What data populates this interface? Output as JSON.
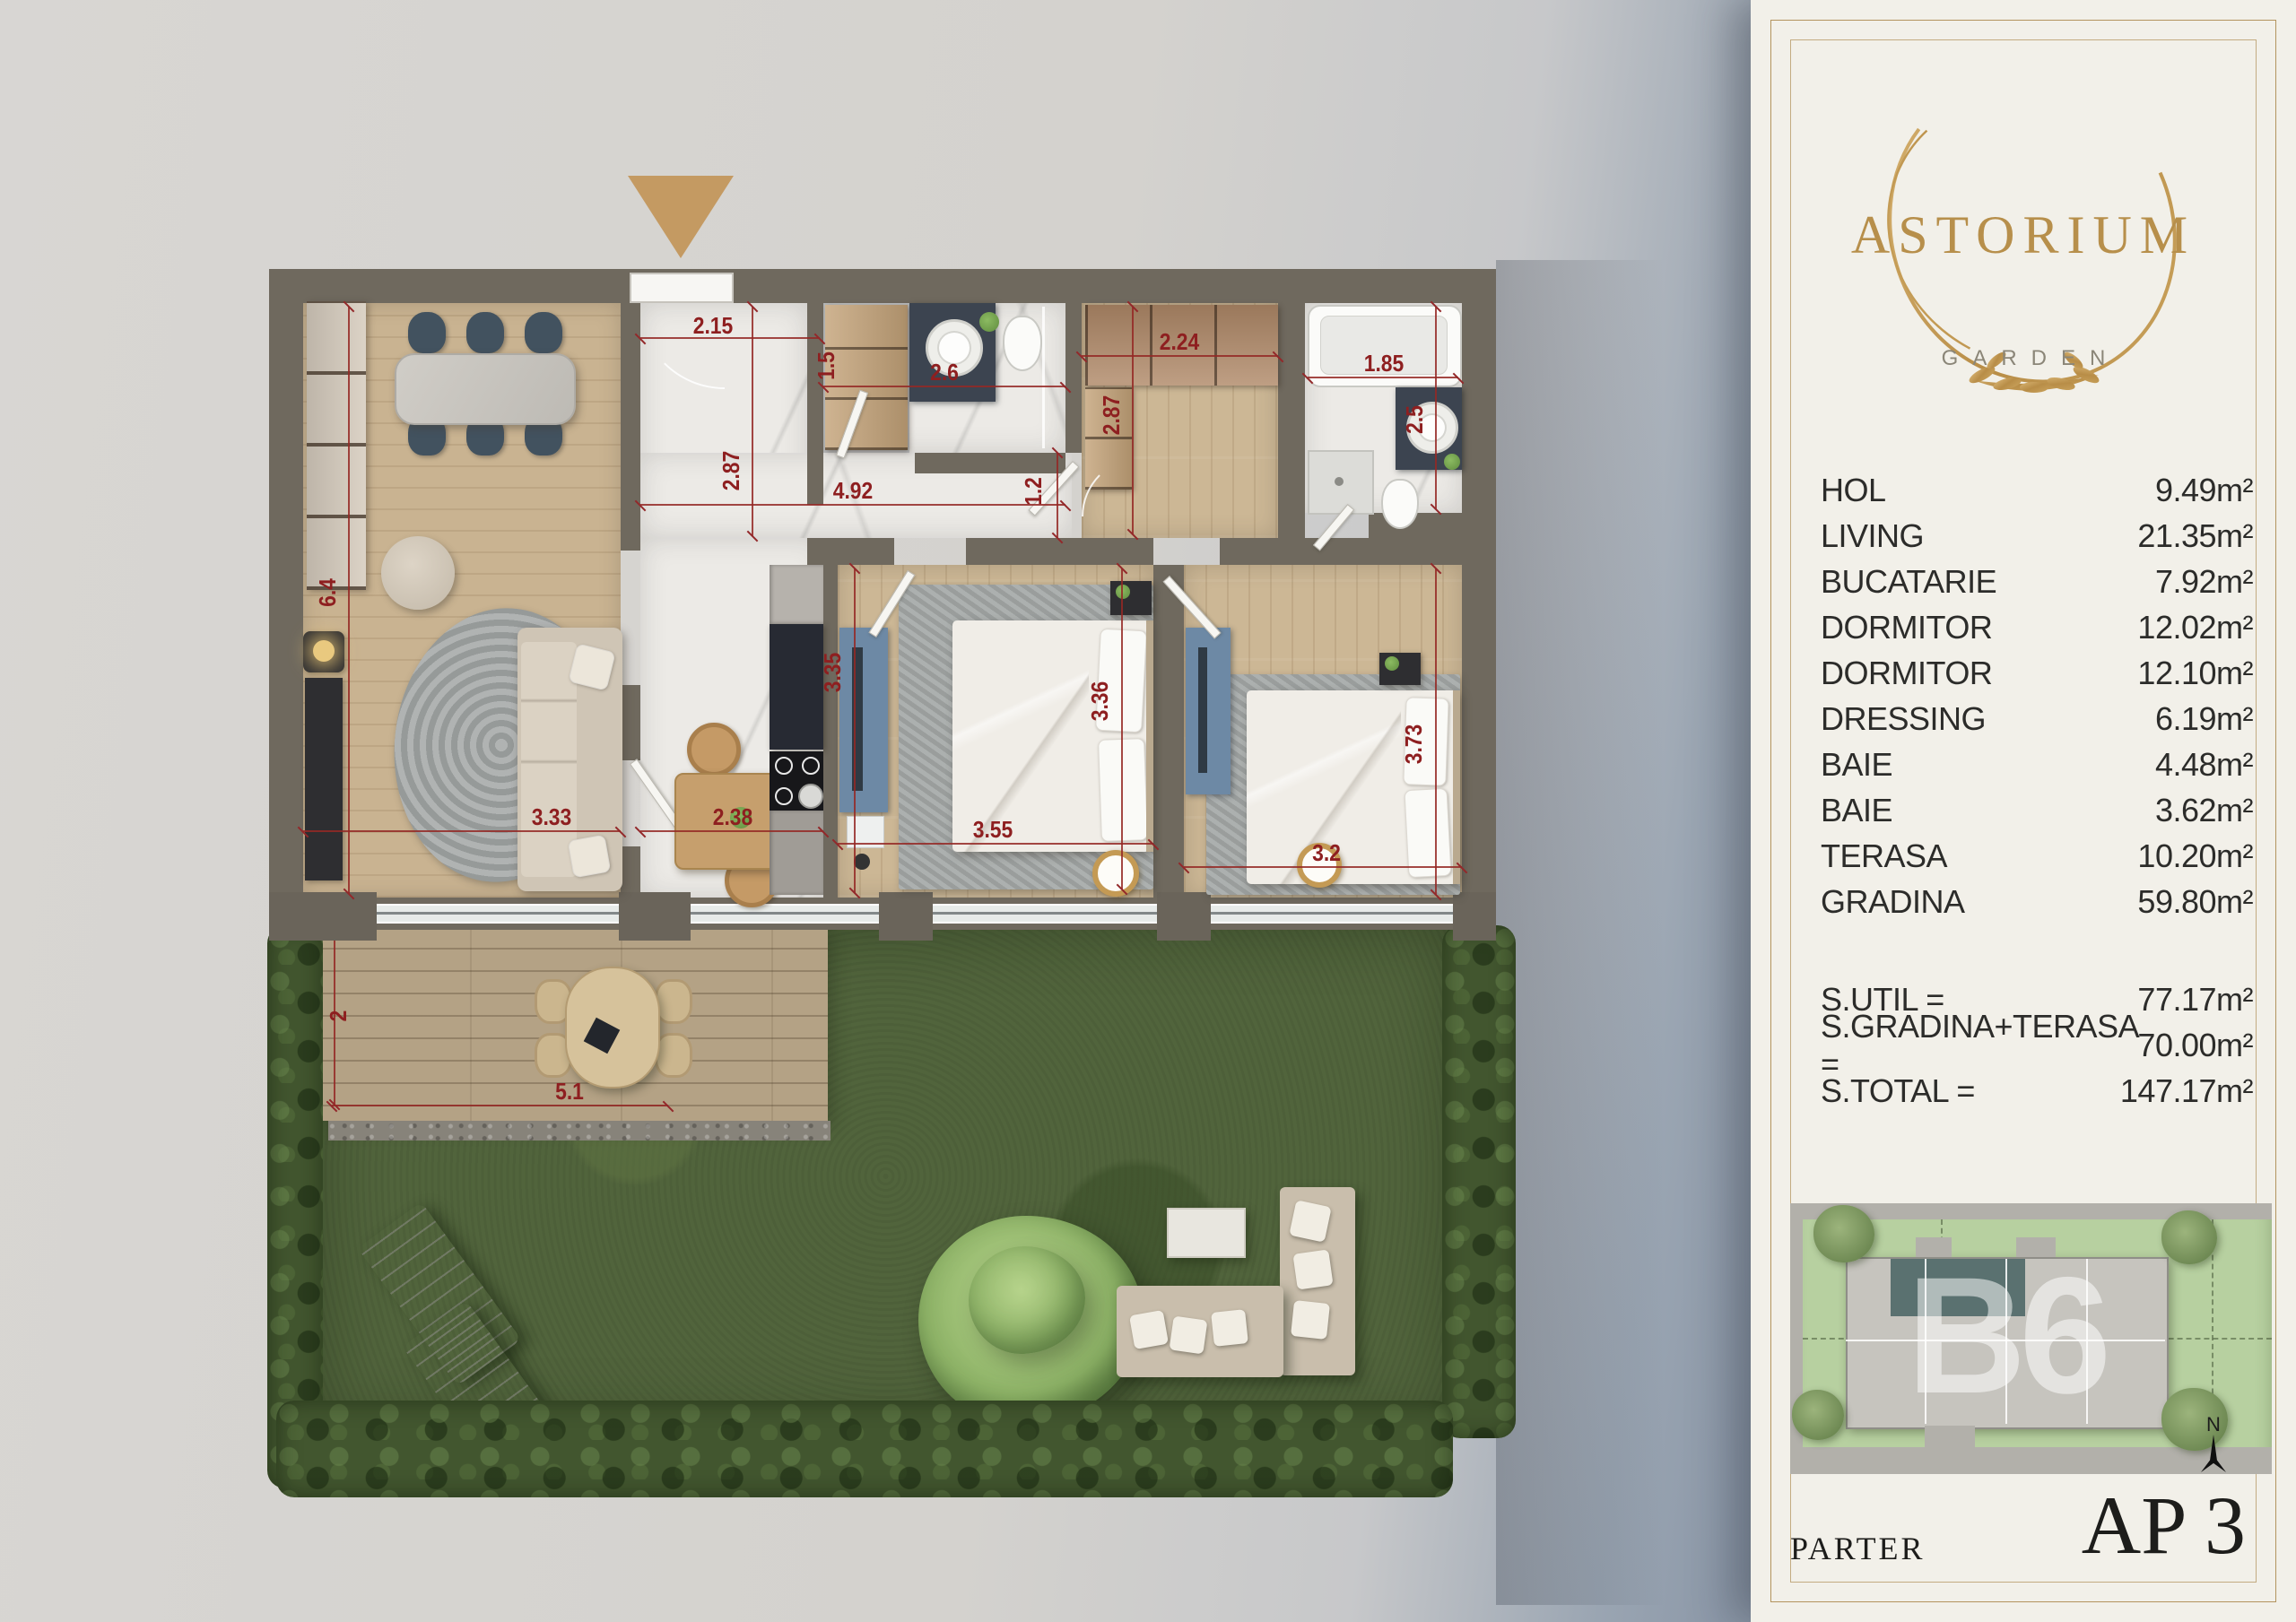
{
  "panel": {
    "logo": {
      "title": "ASTORIUM",
      "subtitle": "GARDEN"
    },
    "rooms": [
      {
        "label": "HOL",
        "area": "9.49m²"
      },
      {
        "label": "LIVING",
        "area": "21.35m²"
      },
      {
        "label": "BUCATARIE",
        "area": "7.92m²"
      },
      {
        "label": "DORMITOR",
        "area": "12.02m²"
      },
      {
        "label": "DORMITOR",
        "area": "12.10m²"
      },
      {
        "label": "DRESSING",
        "area": "6.19m²"
      },
      {
        "label": "BAIE",
        "area": "4.48m²"
      },
      {
        "label": "BAIE",
        "area": "3.62m²"
      },
      {
        "label": "TERASA",
        "area": "10.20m²"
      },
      {
        "label": "GRADINA",
        "area": "59.80m²"
      }
    ],
    "totals": [
      {
        "label": "S.UTIL =",
        "value": "77.17m²"
      },
      {
        "label": "S.GRADINA+TERASA =",
        "value": "70.00m²"
      },
      {
        "label": "S.TOTAL =",
        "value": "147.17m²"
      }
    ],
    "floor_label": "PARTER",
    "unit_label": "AP 3",
    "siteplan": {
      "watermark": "B6",
      "north_label": "N"
    }
  },
  "plan": {
    "dims": [
      "2.15",
      "2.87",
      "1.5",
      "2.6",
      "2.24",
      "2.87",
      "1.85",
      "2.5",
      "4.92",
      "1.2",
      "6.4",
      "3.35",
      "3.36",
      "3.73",
      "3.33",
      "2.38",
      "3.55",
      "3.2",
      "5.1",
      "2"
    ]
  },
  "colors": {
    "gold": "#c49a62",
    "dim_red": "#8e1f20",
    "wall": "#6f695e",
    "panel_bg": "#f2f0e9"
  }
}
